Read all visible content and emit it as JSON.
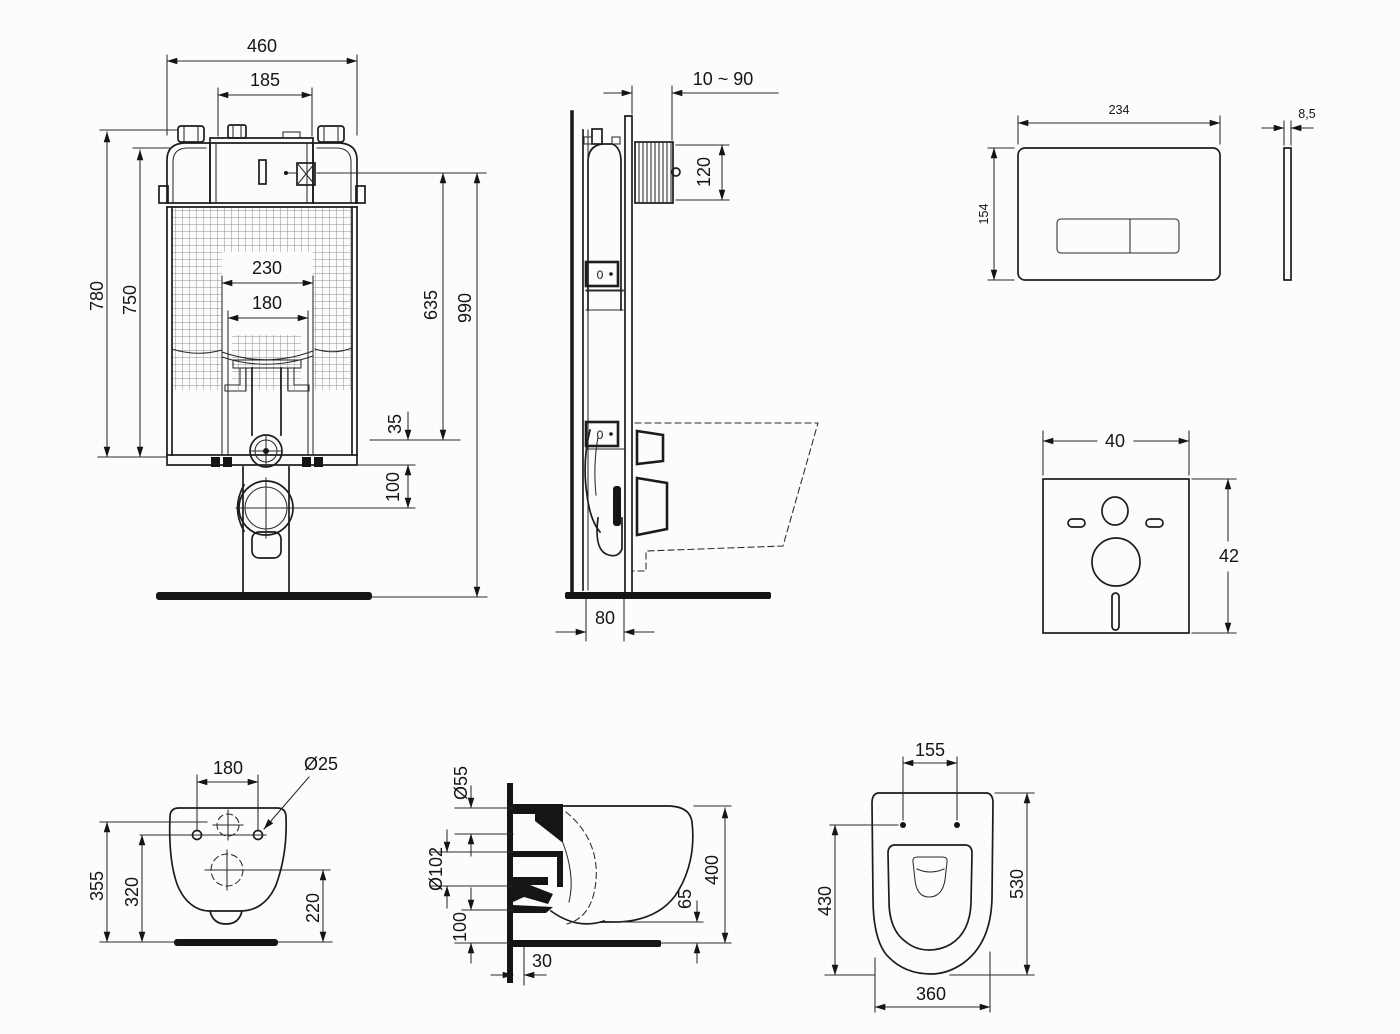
{
  "drawing": {
    "background": "#fcfcfc",
    "line_color": "#1c1c1c",
    "mesh_color": "#8f8f8f"
  },
  "views": {
    "cistern_front": {
      "frame_width": "460",
      "tank_width": "185",
      "frame_height": "780",
      "inner_height": "750",
      "bracket_span": "230",
      "bracket_inner_span": "180",
      "valve_height": "635",
      "total_height": "990",
      "offset_small": "35",
      "offset_pipe": "100"
    },
    "cistern_side": {
      "wall_distance": "10 ~ 90",
      "inspection_box_height": "120",
      "frame_depth": "80",
      "gauge_mark": "0"
    },
    "flush_plate": {
      "width": "234",
      "height": "154",
      "thickness": "8,5"
    },
    "sound_mat": {
      "width": "40",
      "height": "42"
    },
    "toilet_rear": {
      "bolt_spacing": "180",
      "bolt_diameter": "Ø25",
      "height_total": "355",
      "height_bolts": "320",
      "height_outlet": "220"
    },
    "toilet_side": {
      "flush_pipe_diameter": "Ø55",
      "outlet_diameter": "Ø102",
      "outlet_center_height": "100",
      "wall_offset": "30",
      "rim_floor_gap": "65",
      "height": "400"
    },
    "toilet_top": {
      "hinge_spacing": "155",
      "inner_length": "430",
      "total_length": "530",
      "width": "360"
    }
  }
}
